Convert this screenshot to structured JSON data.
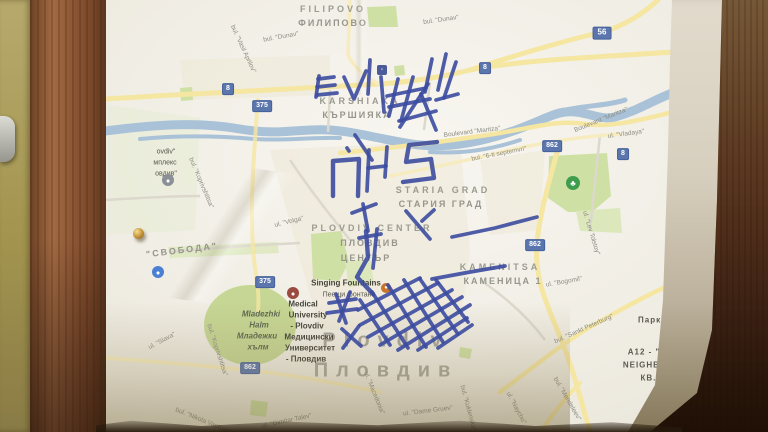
{
  "colors": {
    "marker_ink": "#3c4ba0",
    "road_badge": "#5b76ad",
    "road_yellow": "#f5e6a2",
    "river": "#a9c2d8",
    "park_green": "#cfe0a4",
    "paper": "#f0ede4"
  },
  "map": {
    "labels": [
      {
        "text": "FILIPOVO",
        "x": 333,
        "y": 9,
        "rot": 0,
        "cls": "area",
        "id": "filipovo-en"
      },
      {
        "text": "ФИЛИПОВО",
        "x": 333,
        "y": 23,
        "rot": 0,
        "cls": "areacy",
        "id": "filipovo-bg"
      },
      {
        "text": "KARSHIAKA",
        "x": 360,
        "y": 101,
        "rot": 0,
        "cls": "area",
        "id": "karshiaka-en"
      },
      {
        "text": "КЪРШИЯКА",
        "x": 357,
        "y": 115,
        "rot": 0,
        "cls": "areacy",
        "id": "karshiaka-bg"
      },
      {
        "text": "STARIA GRAD",
        "x": 443,
        "y": 190,
        "rot": 0,
        "cls": "area",
        "id": "staria-grad-en"
      },
      {
        "text": "СТАРИЯ ГРАД",
        "x": 441,
        "y": 204,
        "rot": 0,
        "cls": "areacy",
        "id": "staria-grad-bg"
      },
      {
        "text": "PLOVDIV CENTER",
        "x": 372,
        "y": 228,
        "rot": 0,
        "cls": "area",
        "id": "plovdiv-center-en"
      },
      {
        "text": "ПЛОВДИВ",
        "x": 370,
        "y": 243,
        "rot": 0,
        "cls": "areacy",
        "id": "plovdiv-center-bg1"
      },
      {
        "text": "ЦЕНТЪР",
        "x": 366,
        "y": 258,
        "rot": 0,
        "cls": "areacy",
        "id": "plovdiv-center-bg2"
      },
      {
        "text": "KAMENITSA",
        "x": 500,
        "y": 267,
        "rot": 0,
        "cls": "area",
        "id": "kamenitsa-en"
      },
      {
        "text": "КАМЕНИЦА 1",
        "x": 503,
        "y": 281,
        "rot": 0,
        "cls": "areacy",
        "id": "kamenitsa-bg"
      },
      {
        "text": "\"СВОБОДА\"",
        "x": 182,
        "y": 250,
        "rot": -7,
        "cls": "areacy",
        "id": "svoboda"
      },
      {
        "text": "Plovdiv",
        "x": 386,
        "y": 341,
        "rot": 0,
        "cls": "city",
        "id": "city-en"
      },
      {
        "text": "Пловдив",
        "x": 386,
        "y": 371,
        "rot": 0,
        "cls": "city",
        "id": "city-bg"
      },
      {
        "text": "A12 - \"L",
        "x": 647,
        "y": 352,
        "rot": 0,
        "cls": "dark",
        "id": "a12-1"
      },
      {
        "text": "NEIGHBO",
        "x": 645,
        "y": 365,
        "rot": 0,
        "cls": "dark",
        "id": "a12-2"
      },
      {
        "text": "КВ. Л,",
        "x": 655,
        "y": 378,
        "rot": 0,
        "cls": "dark",
        "id": "a12-3"
      },
      {
        "text": "- A",
        "x": 662,
        "y": 390,
        "rot": 0,
        "cls": "dark",
        "id": "a12-4"
      },
      {
        "text": "G.K",
        "x": 660,
        "y": 409,
        "rot": 0,
        "cls": "dark",
        "id": "gk-en"
      },
      {
        "text": "Ж.К",
        "x": 660,
        "y": 420,
        "rot": 0,
        "cls": "dark",
        "id": "gk-bg"
      },
      {
        "text": "Парк „Л",
        "x": 657,
        "y": 320,
        "rot": 0,
        "cls": "dark",
        "id": "park-l"
      },
      {
        "text": "Singing Fountains",
        "x": 346,
        "y": 283,
        "rot": 0,
        "cls": "poi",
        "id": "fountains-en"
      },
      {
        "text": "Пеещи фонтани",
        "x": 349,
        "y": 295,
        "rot": 0,
        "cls": "poism",
        "id": "fountains-bg"
      },
      {
        "text": "Medical",
        "x": 303,
        "y": 304,
        "rot": 0,
        "cls": "poi",
        "id": "medical-1"
      },
      {
        "text": "University",
        "x": 308,
        "y": 315,
        "rot": 0,
        "cls": "poi",
        "id": "medical-2"
      },
      {
        "text": "- Plovdiv",
        "x": 307,
        "y": 326,
        "rot": 0,
        "cls": "poi",
        "id": "medical-3"
      },
      {
        "text": "Медицински",
        "x": 309,
        "y": 337,
        "rot": 0,
        "cls": "poi",
        "id": "medical-4"
      },
      {
        "text": "Университет",
        "x": 310,
        "y": 348,
        "rot": 0,
        "cls": "poi",
        "id": "medical-5"
      },
      {
        "text": "- Пловдив",
        "x": 306,
        "y": 359,
        "rot": 0,
        "cls": "poi",
        "id": "medical-6"
      },
      {
        "text": "Mladezhki",
        "x": 261,
        "y": 314,
        "rot": 0,
        "cls": "hill",
        "id": "mladezhki-1"
      },
      {
        "text": "Halm",
        "x": 259,
        "y": 325,
        "rot": 0,
        "cls": "hill",
        "id": "mladezhki-2"
      },
      {
        "text": "Младежки",
        "x": 257,
        "y": 336,
        "rot": 0,
        "cls": "hill",
        "id": "mladezhki-3"
      },
      {
        "text": "хълм",
        "x": 258,
        "y": 347,
        "rot": 0,
        "cls": "hill",
        "id": "mladezhki-4"
      },
      {
        "text": "ovdiv\"",
        "x": 166,
        "y": 152,
        "rot": 0,
        "cls": "poism",
        "id": "stadium-1"
      },
      {
        "text": "мплекс",
        "x": 165,
        "y": 163,
        "rot": 0,
        "cls": "poism",
        "id": "stadium-2"
      },
      {
        "text": "овдив\"",
        "x": 166,
        "y": 174,
        "rot": 0,
        "cls": "poism",
        "id": "stadium-3"
      },
      {
        "text": "bul. \"Dunav\"",
        "x": 281,
        "y": 37,
        "rot": -10,
        "cls": "street",
        "id": "dunav-1"
      },
      {
        "text": "bul. \"Dunav\"",
        "x": 441,
        "y": 20,
        "rot": -8,
        "cls": "street",
        "id": "dunav-2"
      },
      {
        "text": "bul. \"Vasil Aprilov\"",
        "x": 243,
        "y": 49,
        "rot": 65,
        "cls": "street",
        "id": "vasil-aprilov"
      },
      {
        "text": "Boulevard \"Maritza\"",
        "x": 472,
        "y": 132,
        "rot": -7,
        "cls": "street",
        "id": "maritza-1"
      },
      {
        "text": "Boulevard \"Maritza\"",
        "x": 601,
        "y": 120,
        "rot": -22,
        "cls": "street",
        "id": "maritza-2"
      },
      {
        "text": "bul. \"6-ti septemvri\"",
        "x": 499,
        "y": 154,
        "rot": -11,
        "cls": "street",
        "id": "septemvri"
      },
      {
        "text": "ul. \"Vladaya\"",
        "x": 626,
        "y": 134,
        "rot": -8,
        "cls": "street",
        "id": "vladaya"
      },
      {
        "text": "ul. \"Lev Tolstoy\"",
        "x": 591,
        "y": 233,
        "rot": 73,
        "cls": "street",
        "id": "lev-tolstoy"
      },
      {
        "text": "ul. \"Bogomil\"",
        "x": 564,
        "y": 282,
        "rot": -10,
        "cls": "street",
        "id": "bogomil"
      },
      {
        "text": "bul. \"Sankt Peterburg\"",
        "x": 584,
        "y": 329,
        "rot": -24,
        "cls": "street",
        "id": "sankt-peterburg"
      },
      {
        "text": "bul. \"Mendeleev\"",
        "x": 567,
        "y": 399,
        "rot": 60,
        "cls": "street",
        "id": "mendeleev"
      },
      {
        "text": "ul. \"Dame Gruev\"",
        "x": 428,
        "y": 411,
        "rot": -7,
        "cls": "street",
        "id": "dame-gruev"
      },
      {
        "text": "ul. \"Macedonia\"",
        "x": 374,
        "y": 393,
        "rot": 68,
        "cls": "street",
        "id": "macedonia"
      },
      {
        "text": "bul. \"Kuklensko\"",
        "x": 468,
        "y": 408,
        "rot": 75,
        "cls": "street",
        "id": "kuklensko"
      },
      {
        "text": "ul. \"Naycho\"",
        "x": 516,
        "y": 408,
        "rot": 62,
        "cls": "street",
        "id": "naycho"
      },
      {
        "text": "ul. \"Volga\"",
        "x": 289,
        "y": 222,
        "rot": -14,
        "cls": "street",
        "id": "volga"
      },
      {
        "text": "bul. \"Koprivshtitsa\"",
        "x": 201,
        "y": 183,
        "rot": 67,
        "cls": "street",
        "id": "koprivshtitsa-1"
      },
      {
        "text": "bul. \"Koprivshtitsa\"",
        "x": 217,
        "y": 350,
        "rot": 72,
        "cls": "street",
        "id": "koprivshtitsa-2"
      },
      {
        "text": "ul. \"Slava\"",
        "x": 162,
        "y": 341,
        "rot": -28,
        "cls": "street",
        "id": "slava"
      },
      {
        "text": "bul. \"Nikola Vaptsarov\"",
        "x": 206,
        "y": 422,
        "rot": 22,
        "cls": "street",
        "id": "vaptsarov"
      },
      {
        "text": "ul. \"Dimitar Talev\"",
        "x": 287,
        "y": 421,
        "rot": -12,
        "cls": "street",
        "id": "dimitar-talev"
      }
    ],
    "badges": [
      {
        "text": "8",
        "x": 228,
        "y": 89
      },
      {
        "text": "375",
        "x": 262,
        "y": 106
      },
      {
        "text": "8",
        "x": 485,
        "y": 68
      },
      {
        "text": "56",
        "x": 602,
        "y": 33,
        "big": true
      },
      {
        "text": "862",
        "x": 552,
        "y": 146
      },
      {
        "text": "8",
        "x": 623,
        "y": 154
      },
      {
        "text": "862",
        "x": 535,
        "y": 245
      },
      {
        "text": "375",
        "x": 265,
        "y": 282
      },
      {
        "text": "862",
        "x": 250,
        "y": 368
      }
    ],
    "icons": [
      {
        "name": "tree-icon",
        "x": 573,
        "y": 183,
        "d": 14,
        "color": "#3f9e4e",
        "glyph": "♣"
      },
      {
        "name": "stadium-icon",
        "x": 168,
        "y": 180,
        "d": 12,
        "color": "#8a8f98",
        "glyph": "●"
      },
      {
        "name": "sport-poi-icon",
        "x": 158,
        "y": 272,
        "d": 12,
        "color": "#4a7fd4",
        "glyph": "●"
      },
      {
        "name": "fountain-icon",
        "x": 386,
        "y": 288,
        "d": 10,
        "color": "#c8742a",
        "glyph": "●"
      },
      {
        "name": "university-icon",
        "x": 293,
        "y": 293,
        "d": 12,
        "color": "#9a4a3f",
        "glyph": "●"
      },
      {
        "name": "transit-square-icon",
        "x": 382,
        "y": 70,
        "d": 10,
        "color": "#4a5a9a",
        "glyph": "▫",
        "square": true
      }
    ]
  },
  "annotations": {
    "description": "hand-drawn blue marker scribbles",
    "color": "#3c4ba0",
    "strokes": [
      [
        318,
        79,
        334,
        77
      ],
      [
        317,
        87,
        335,
        85
      ],
      [
        317,
        95,
        337,
        93
      ],
      [
        319,
        76,
        316,
        97
      ],
      [
        344,
        77,
        354,
        99,
        366,
        71
      ],
      [
        370,
        60,
        368,
        94
      ],
      [
        381,
        77,
        384,
        112
      ],
      [
        387,
        96,
        426,
        88
      ],
      [
        389,
        107,
        430,
        99
      ],
      [
        399,
        121,
        436,
        111
      ],
      [
        398,
        79,
        389,
        116
      ],
      [
        413,
        77,
        401,
        121
      ],
      [
        428,
        84,
        400,
        127
      ],
      [
        432,
        59,
        425,
        92
      ],
      [
        446,
        54,
        438,
        90
      ],
      [
        456,
        62,
        444,
        98
      ],
      [
        421,
        94,
        436,
        130
      ],
      [
        436,
        100,
        458,
        94
      ],
      [
        355,
        135,
        372,
        160
      ],
      [
        333,
        196,
        333,
        161,
        359,
        159,
        358,
        196
      ],
      [
        369,
        150,
        367,
        191
      ],
      [
        387,
        147,
        385,
        177
      ],
      [
        368,
        168,
        386,
        166
      ],
      [
        437,
        142,
        409,
        145,
        406,
        162,
        431,
        159,
        434,
        178,
        403,
        182
      ],
      [
        347,
        148,
        349,
        151
      ],
      [
        352,
        213,
        376,
        204
      ],
      [
        363,
        204,
        368,
        231
      ],
      [
        366,
        231,
        368,
        257,
        357,
        277,
        373,
        294
      ],
      [
        359,
        238,
        381,
        234
      ],
      [
        377,
        229,
        373,
        268
      ],
      [
        406,
        211,
        430,
        239
      ],
      [
        422,
        221,
        434,
        210
      ],
      [
        452,
        237,
        495,
        228,
        537,
        217
      ],
      [
        432,
        279,
        470,
        272,
        505,
        266
      ],
      [
        329,
        303,
        356,
        299
      ],
      [
        327,
        313,
        357,
        309
      ],
      [
        336,
        294,
        346,
        323
      ],
      [
        350,
        292,
        339,
        321
      ],
      [
        342,
        329,
        361,
        346
      ],
      [
        359,
        326,
        343,
        348
      ],
      [
        358,
        310,
        420,
        278
      ],
      [
        360,
        325,
        438,
        283
      ],
      [
        368,
        337,
        452,
        290
      ],
      [
        380,
        345,
        462,
        297
      ],
      [
        398,
        350,
        470,
        305
      ],
      [
        418,
        350,
        467,
        318
      ],
      [
        438,
        348,
        472,
        325
      ],
      [
        360,
        300,
        390,
        345
      ],
      [
        372,
        292,
        408,
        348
      ],
      [
        388,
        285,
        426,
        347
      ],
      [
        404,
        280,
        443,
        342
      ],
      [
        420,
        279,
        458,
        334
      ],
      [
        436,
        280,
        468,
        322
      ]
    ]
  }
}
